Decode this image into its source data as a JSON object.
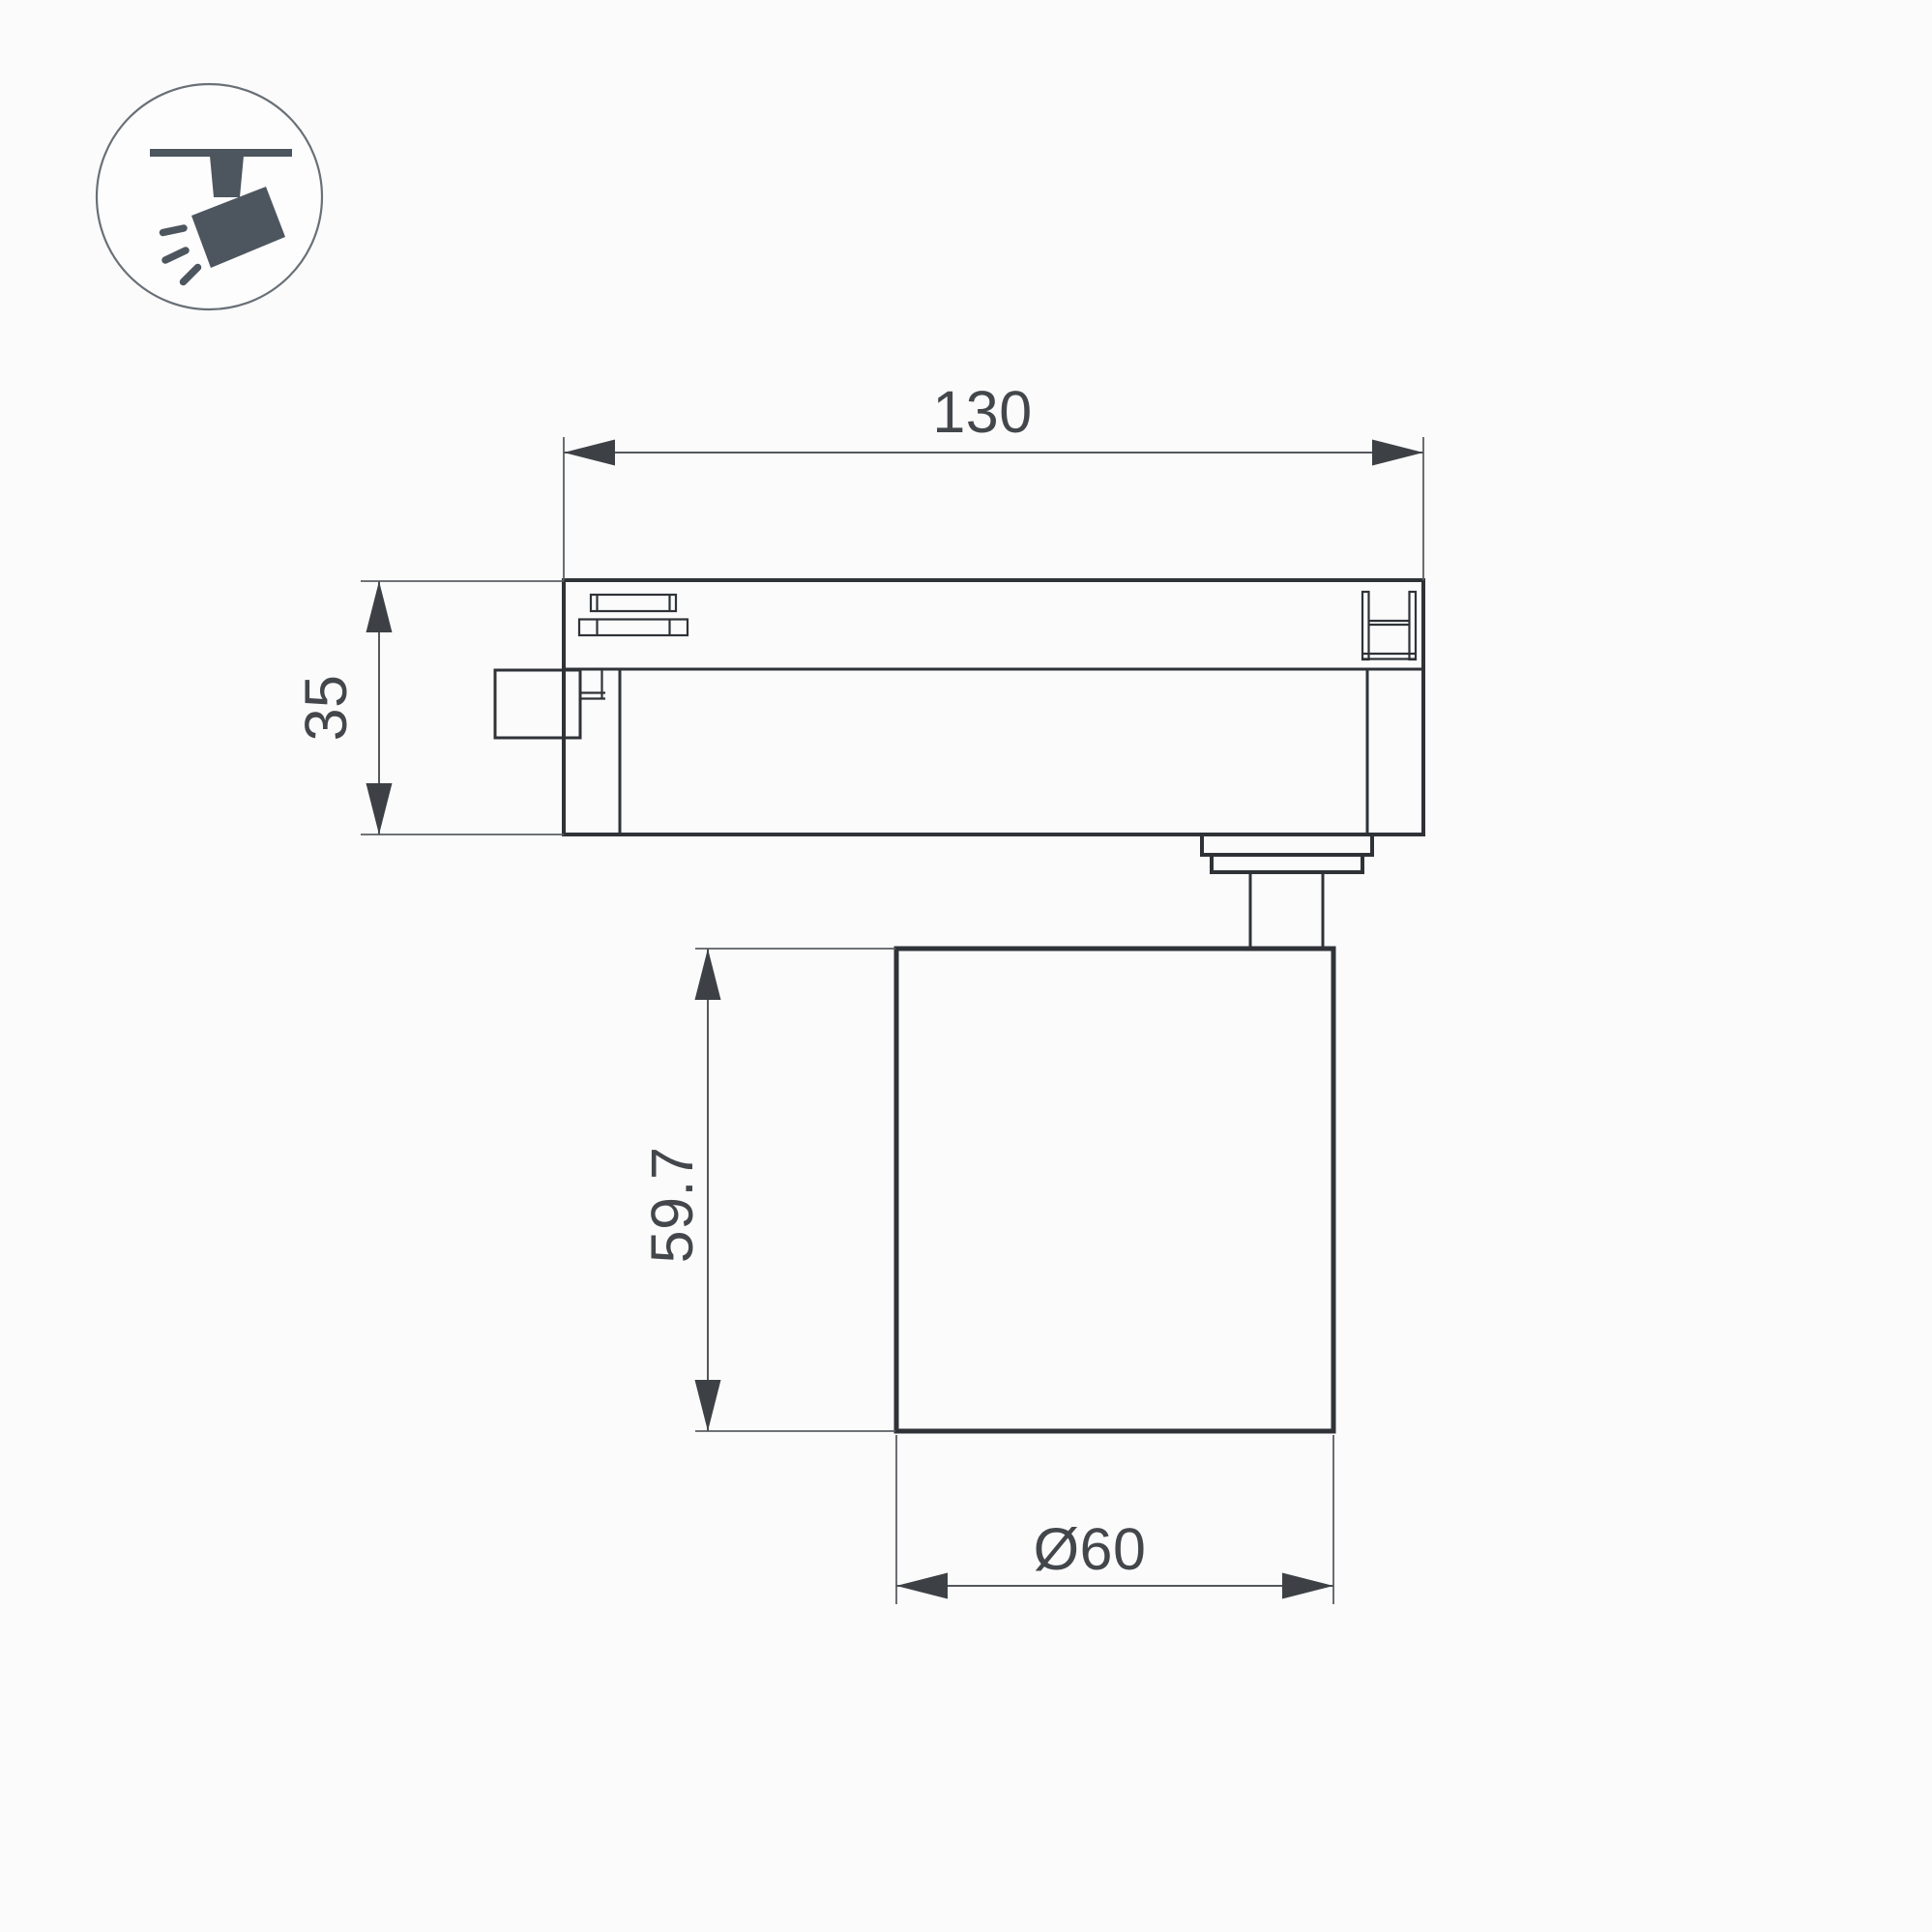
{
  "canvas": {
    "background": "#fbfbfc"
  },
  "colors": {
    "outline": "#2f3337",
    "dimension_line": "#54585c",
    "arrow": "#3d4145",
    "text": "#43474b",
    "icon": "#4d565e",
    "icon_circle_stroke": "#697076"
  },
  "icon": {
    "name": "track-spotlight-icon"
  },
  "dimensions": {
    "track_width": "130",
    "adapter_height": "35",
    "lamp_height": "59.7",
    "lamp_diameter": "Ø60"
  }
}
